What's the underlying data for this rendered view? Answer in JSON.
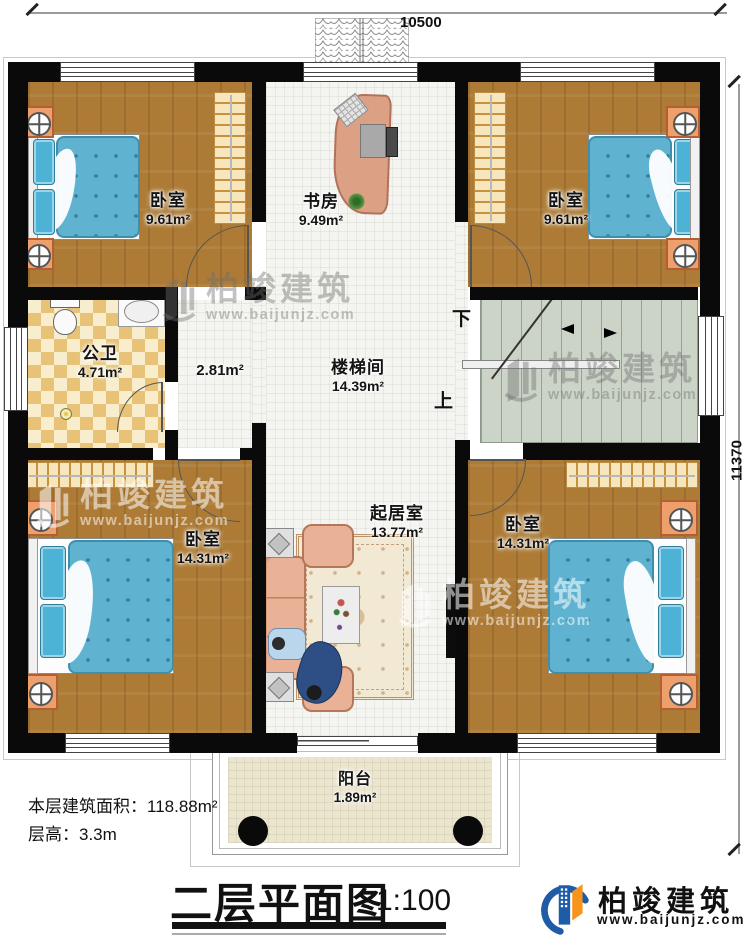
{
  "dimensions": {
    "top": "10500",
    "right": "11370"
  },
  "rooms": {
    "bedroom_tl": {
      "label": "卧室",
      "area": "9.61m²"
    },
    "bedroom_tr": {
      "label": "卧室",
      "area": "9.61m²"
    },
    "study": {
      "label": "书房",
      "area": "9.49m²"
    },
    "bathroom": {
      "label": "公卫",
      "area": "4.71m²"
    },
    "hallway": {
      "area": "2.81m²"
    },
    "stairwell": {
      "label": "楼梯间",
      "area": "14.39m²"
    },
    "bedroom_bl": {
      "label": "卧室",
      "area": "14.31m²"
    },
    "living": {
      "label": "起居室",
      "area": "13.77m²"
    },
    "bedroom_br": {
      "label": "卧室",
      "area": "14.31m²"
    },
    "balcony": {
      "label": "阳台",
      "area": "1.89m²"
    }
  },
  "stairs": {
    "down_label": "下",
    "up_label": "上"
  },
  "footer": {
    "area_line": "本层建筑面积：118.88m²",
    "height_line": "层高：3.3m",
    "title": "二层平面图",
    "scale": "1:100"
  },
  "brand": {
    "name": "柏竣建筑",
    "site": "www.baijunjz.com"
  },
  "watermark": {
    "name": "柏竣建筑",
    "site": "www.baijunjz.com"
  },
  "colors": {
    "wall": "#0a0a0a",
    "wood": "#ad7b35",
    "bed": "#5fb3d0",
    "bath_tile": "#e8c377",
    "stairs": "#cbd4c7",
    "logo_blue": "#1e5ca8",
    "logo_orange": "#f7941d"
  }
}
